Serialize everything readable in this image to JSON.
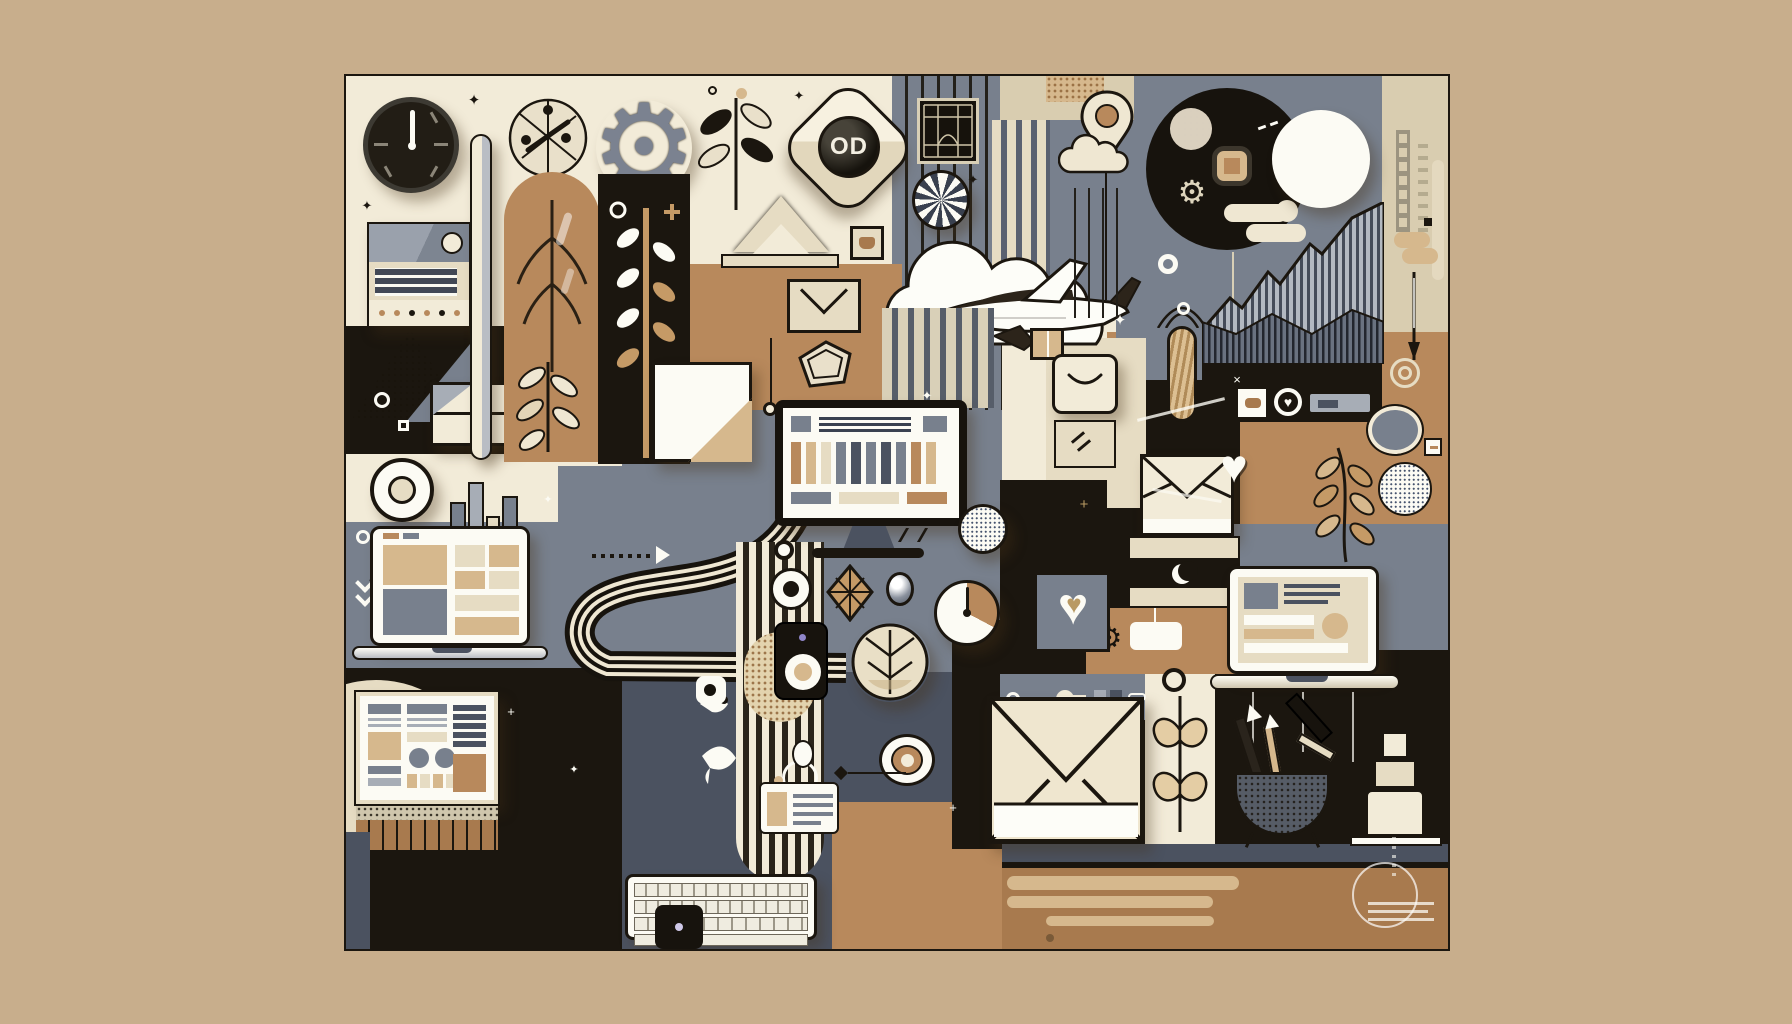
{
  "artwork": {
    "title_note": "abstract flat-design tech/office collage",
    "background_color": "#c8ae8c",
    "frame_color": "#1b160f",
    "objects": [
      "wall-clock",
      "radio-card",
      "halftone-pyramid",
      "parcel-box",
      "donut",
      "coffee-cup",
      "book-stack",
      "laptop-left",
      "webpage-card",
      "brown-slats",
      "sand-dollar-medallion",
      "steel-gear",
      "capsule-bar",
      "leaf-arch-column",
      "wheat-stalk",
      "leaf-branch",
      "lens-app-icon",
      "roof-triangle",
      "mini-frame",
      "envelope-outline-icon",
      "pentagon-badge",
      "folded-letter",
      "pinstripe-panel",
      "lattice-picture",
      "pinwheel-shell",
      "cloud",
      "airplane",
      "parcel-mini",
      "desktop-monitor",
      "dashboard-screen",
      "curved-road",
      "stripe-column",
      "control-knobs",
      "diamond-leaf",
      "glossy-button",
      "timer-pie",
      "dotted-sphere",
      "speaker",
      "leaf-coin",
      "bullseye",
      "egg-and-ring",
      "note-card",
      "bird-doodles",
      "keyboard",
      "tablet-mini",
      "location-pin",
      "cloud-outline",
      "smile-bag",
      "hatched-capsule",
      "cream-envelope",
      "crescent-band",
      "tag-panel",
      "dark-moon-circle",
      "moon",
      "squircle-button",
      "mini-gear",
      "puff-cloud",
      "stripe-mountains",
      "tick-strip",
      "s-bracket",
      "needle",
      "circuit-panel",
      "photo-square",
      "heart-key",
      "slate-ring",
      "dotted-sphere-2",
      "leaf-sprig",
      "heart-down",
      "concentric-rings",
      "laptop-right",
      "heart-tile",
      "key-row",
      "big-envelope",
      "cream-pillar",
      "heart-leaf-plant",
      "pencil-cup",
      "block-sculpture",
      "shelf",
      "capsule-bars",
      "circle-scribble"
    ]
  },
  "palette": {
    "bg": "#c8ae8c",
    "ink": "#1b160f",
    "cream": "#f2ebd8",
    "cream2": "#e6dcc3",
    "beige": "#d9cdb0",
    "white": "#fcfbf4",
    "tan": "#b8895c",
    "tanl": "#d6b88d",
    "brown": "#a87a4e",
    "slate": "#78808d",
    "slated": "#4b5260",
    "slatel": "#a7adb6",
    "navy": "#3a4150",
    "gold": "#b99a63"
  },
  "icons": {
    "lens_label": "OD",
    "gear": "⚙",
    "heart": "♥",
    "sparkle": "✦",
    "plus": "+",
    "cross": "×"
  }
}
